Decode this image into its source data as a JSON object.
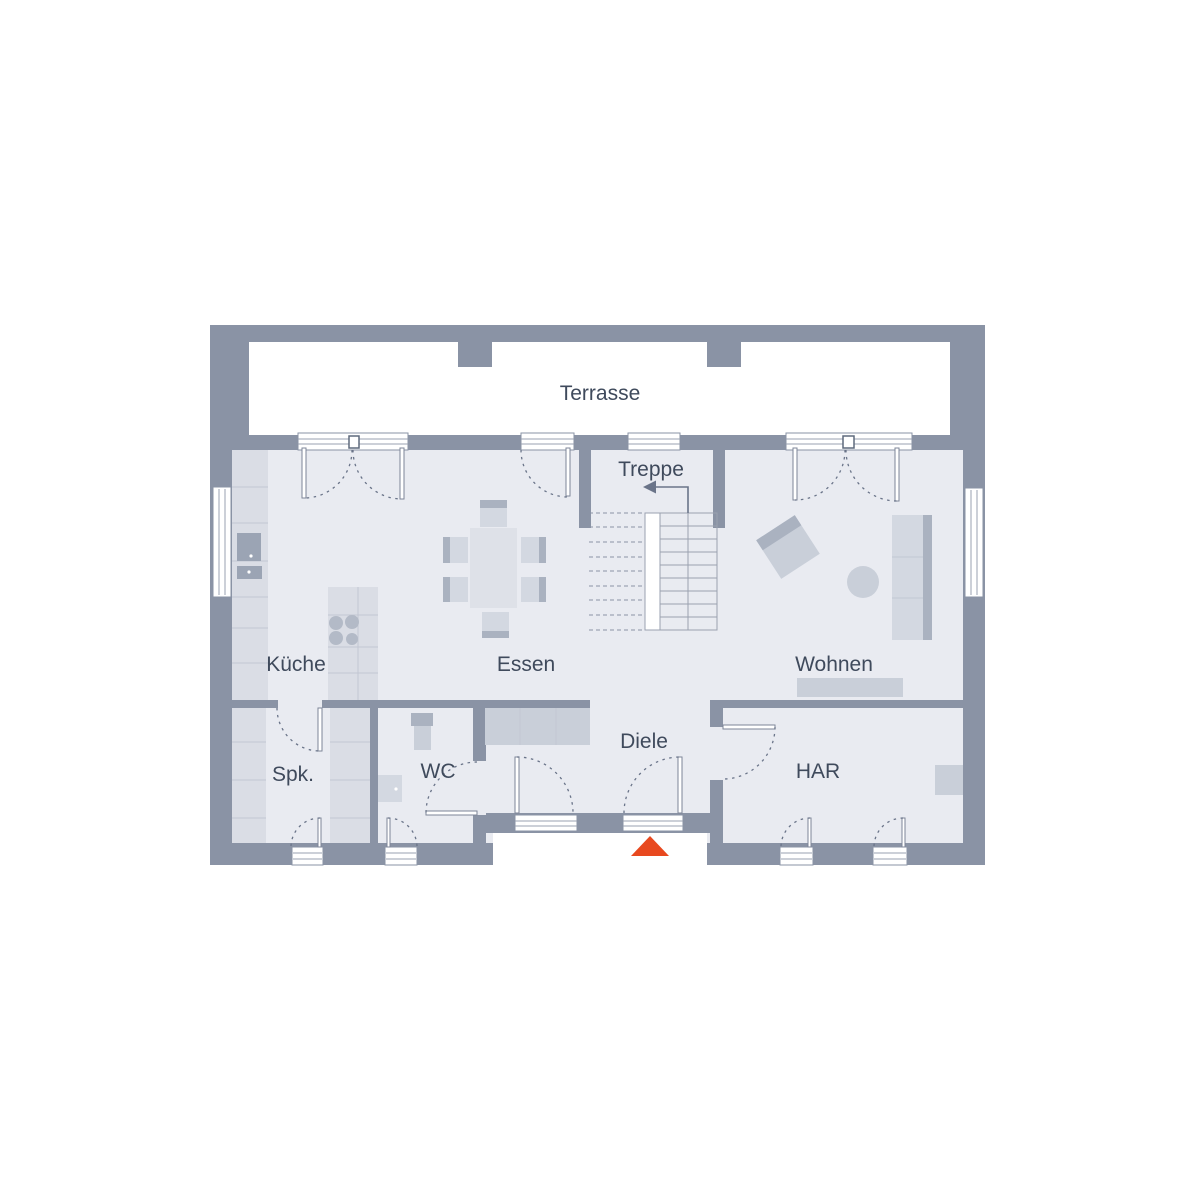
{
  "plan": {
    "title": "Erdgeschoss Grundriss",
    "labels": {
      "terrace": "Terrasse",
      "stairs": "Treppe",
      "kitchen": "Küche",
      "dining": "Essen",
      "living": "Wohnen",
      "hallway": "Diele",
      "pantry": "Spk.",
      "wc": "WC",
      "utility": "HAR"
    },
    "palette": {
      "wall": "#8a93a5",
      "floor": "#e9ebf1",
      "terrace": "#ffffff",
      "furniture_light": "#dadde5",
      "furniture_mid": "#c9cfd9",
      "furniture_dark": "#aab2c0",
      "appliance": "#9ba4b4",
      "swing_line": "#6a7489",
      "label_text": "#3f4a5c",
      "entrance_accent": "#e8491f"
    }
  }
}
